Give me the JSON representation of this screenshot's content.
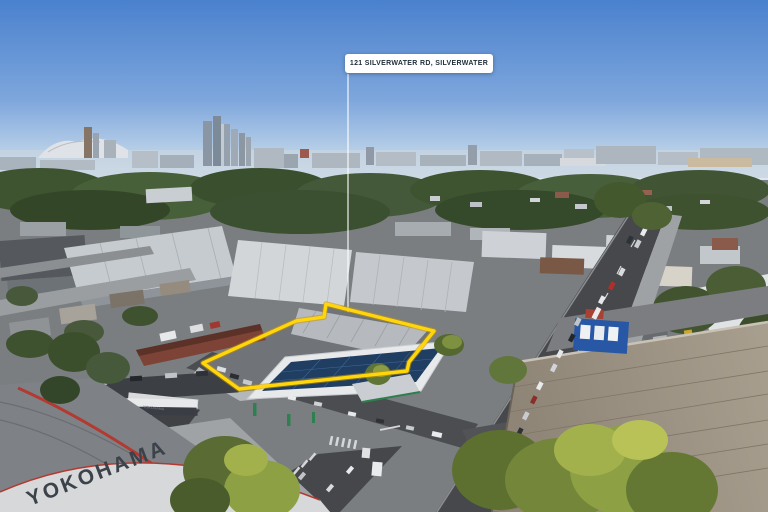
{
  "annotation": {
    "label": "121 SILVERWATER RD, SILVERWATER"
  },
  "signs": {
    "yokohama_roof": "YOKOHAMA",
    "yokohama_fascia": "YOKOHAMA"
  },
  "colors": {
    "highlight": "#FFD60A",
    "label_bg": "#FFFFFF",
    "label_text": "#222F3D",
    "sky_top": "#4A81CE",
    "sky_horizon": "#DDE7F1",
    "solar_panels": "#1F3E61",
    "canopy_green": "#2E8050"
  }
}
